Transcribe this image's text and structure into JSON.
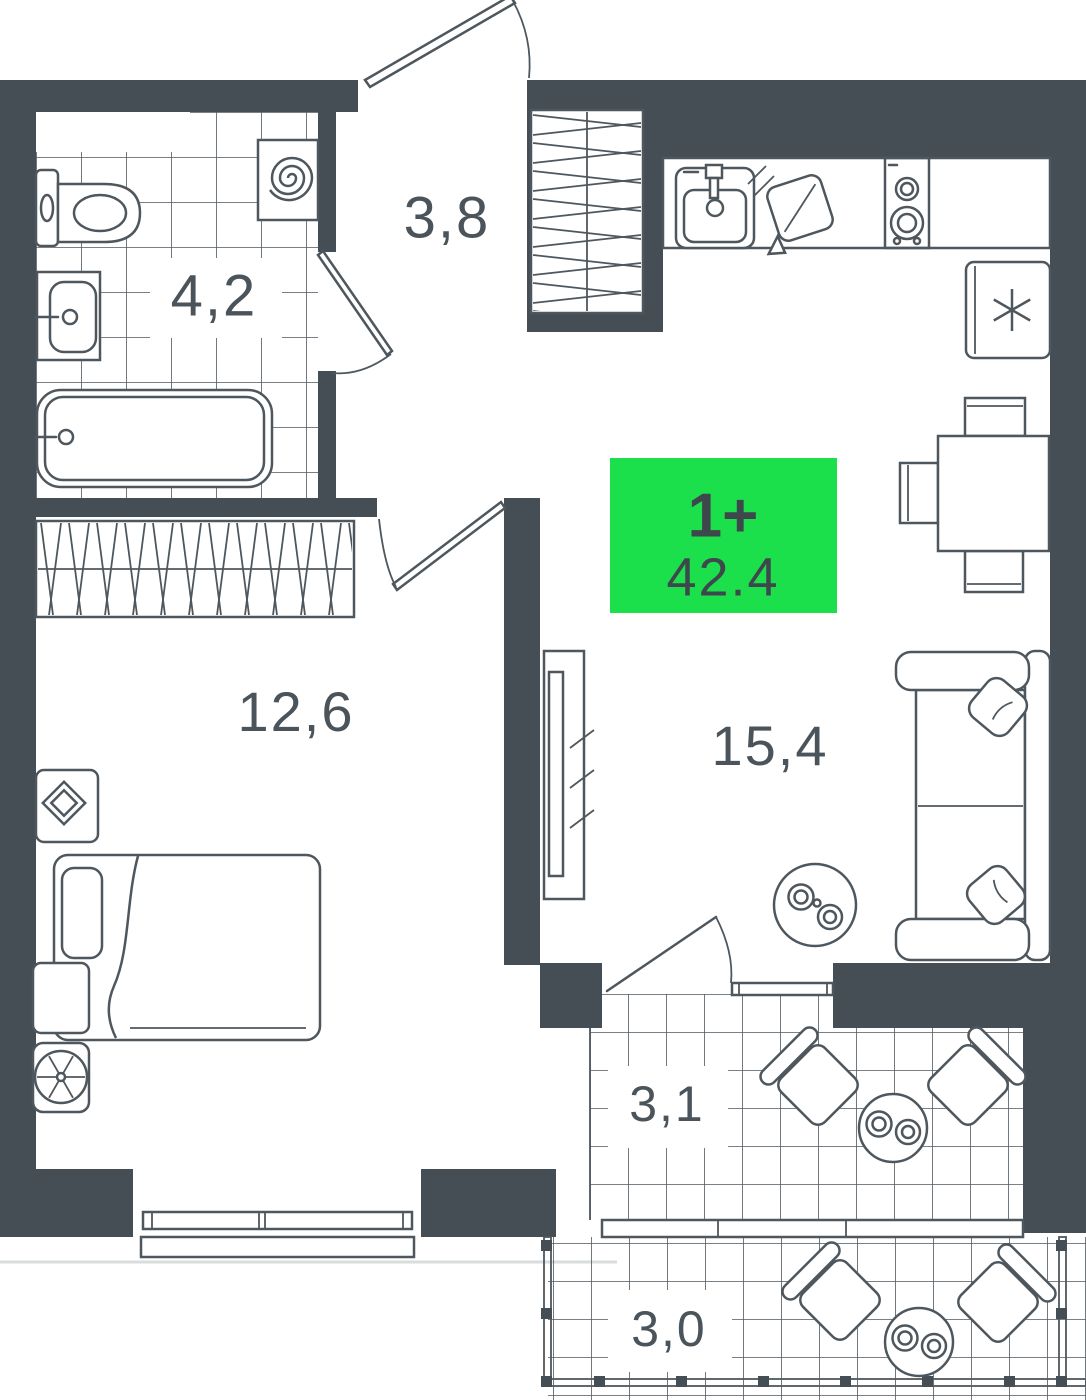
{
  "plan": {
    "badge": {
      "type_label": "1+",
      "total_area": "42.4"
    },
    "rooms": [
      {
        "id": "bathroom",
        "area_label": "4,2"
      },
      {
        "id": "hallway",
        "area_label": "3,8"
      },
      {
        "id": "bedroom",
        "area_label": "12,6"
      },
      {
        "id": "living-kitchen",
        "area_label": "15,4"
      },
      {
        "id": "balcony",
        "area_label": "3,1"
      },
      {
        "id": "terrace",
        "area_label": "3,0"
      }
    ],
    "colors": {
      "wall": "#454E54",
      "line": "#4E575D",
      "accent_green": "#1CDF4C",
      "badge_text": "#3E474C",
      "background": "#FFFFFF",
      "facade_line": "#D9DDDD"
    },
    "symbols": [
      "toilet",
      "bathroom-sink",
      "bathtub",
      "washing-machine-spiral",
      "entry-door",
      "bathroom-door",
      "bedroom-door",
      "balcony-door",
      "entry-wardrobe-hatch",
      "bedroom-wardrobe-hatch",
      "kitchen-sink",
      "stove-burners",
      "cutting-board",
      "fridge-snowflake",
      "dining-table-with-chairs",
      "sofa-with-pillows",
      "coffee-table-with-cups",
      "tv-stand",
      "bed-with-blanket",
      "nightstand-lamp",
      "ventilation-fan",
      "window",
      "balcony-glazing",
      "terrace-railing",
      "outdoor-chairs",
      "outdoor-table"
    ]
  }
}
